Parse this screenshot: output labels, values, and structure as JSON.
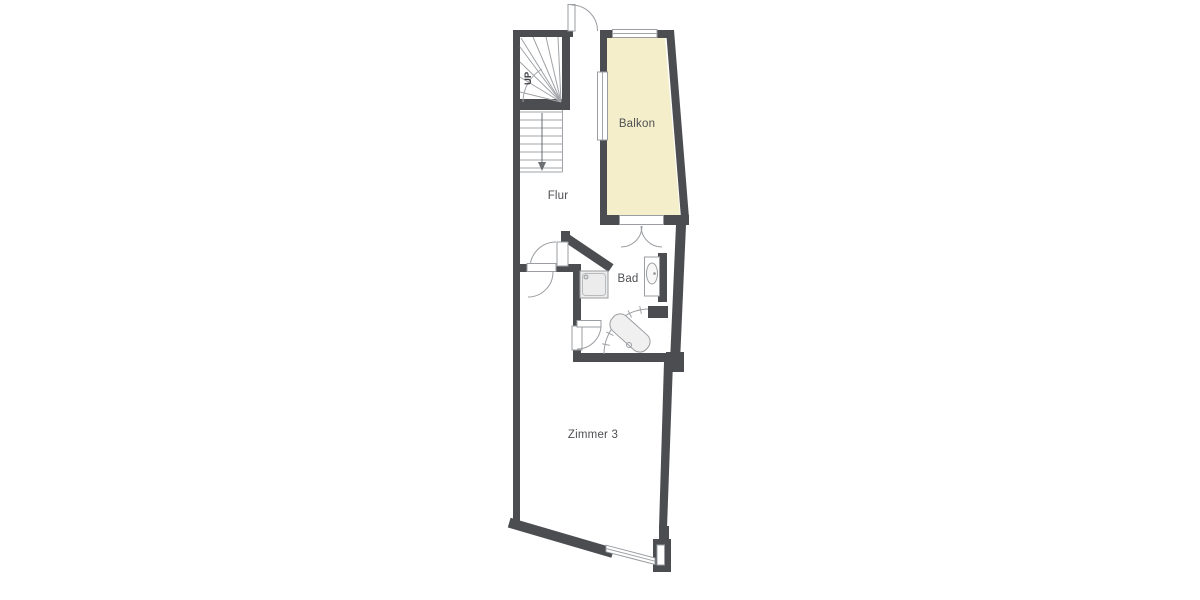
{
  "page": {
    "background": "#ffffff"
  },
  "floor_plan": {
    "rooms": [
      {
        "id": "balkon",
        "label": "Balkon"
      },
      {
        "id": "flur",
        "label": "Flur"
      },
      {
        "id": "bad",
        "label": "Bad"
      },
      {
        "id": "zimmer3",
        "label": "Zimmer 3"
      }
    ],
    "stairs": {
      "direction_label": "UP"
    },
    "fixtures": [
      {
        "id": "shower",
        "name": "shower-tray"
      },
      {
        "id": "sink",
        "name": "washbasin"
      },
      {
        "id": "bathtub",
        "name": "corner-bathtub"
      }
    ],
    "colors": {
      "wall": "#4b4d51",
      "balcony_fill": "#f4efca",
      "fixture_fill": "#ececec",
      "line": "#a0a3a7",
      "label": "#4d4f53",
      "background": "#ffffff"
    }
  }
}
